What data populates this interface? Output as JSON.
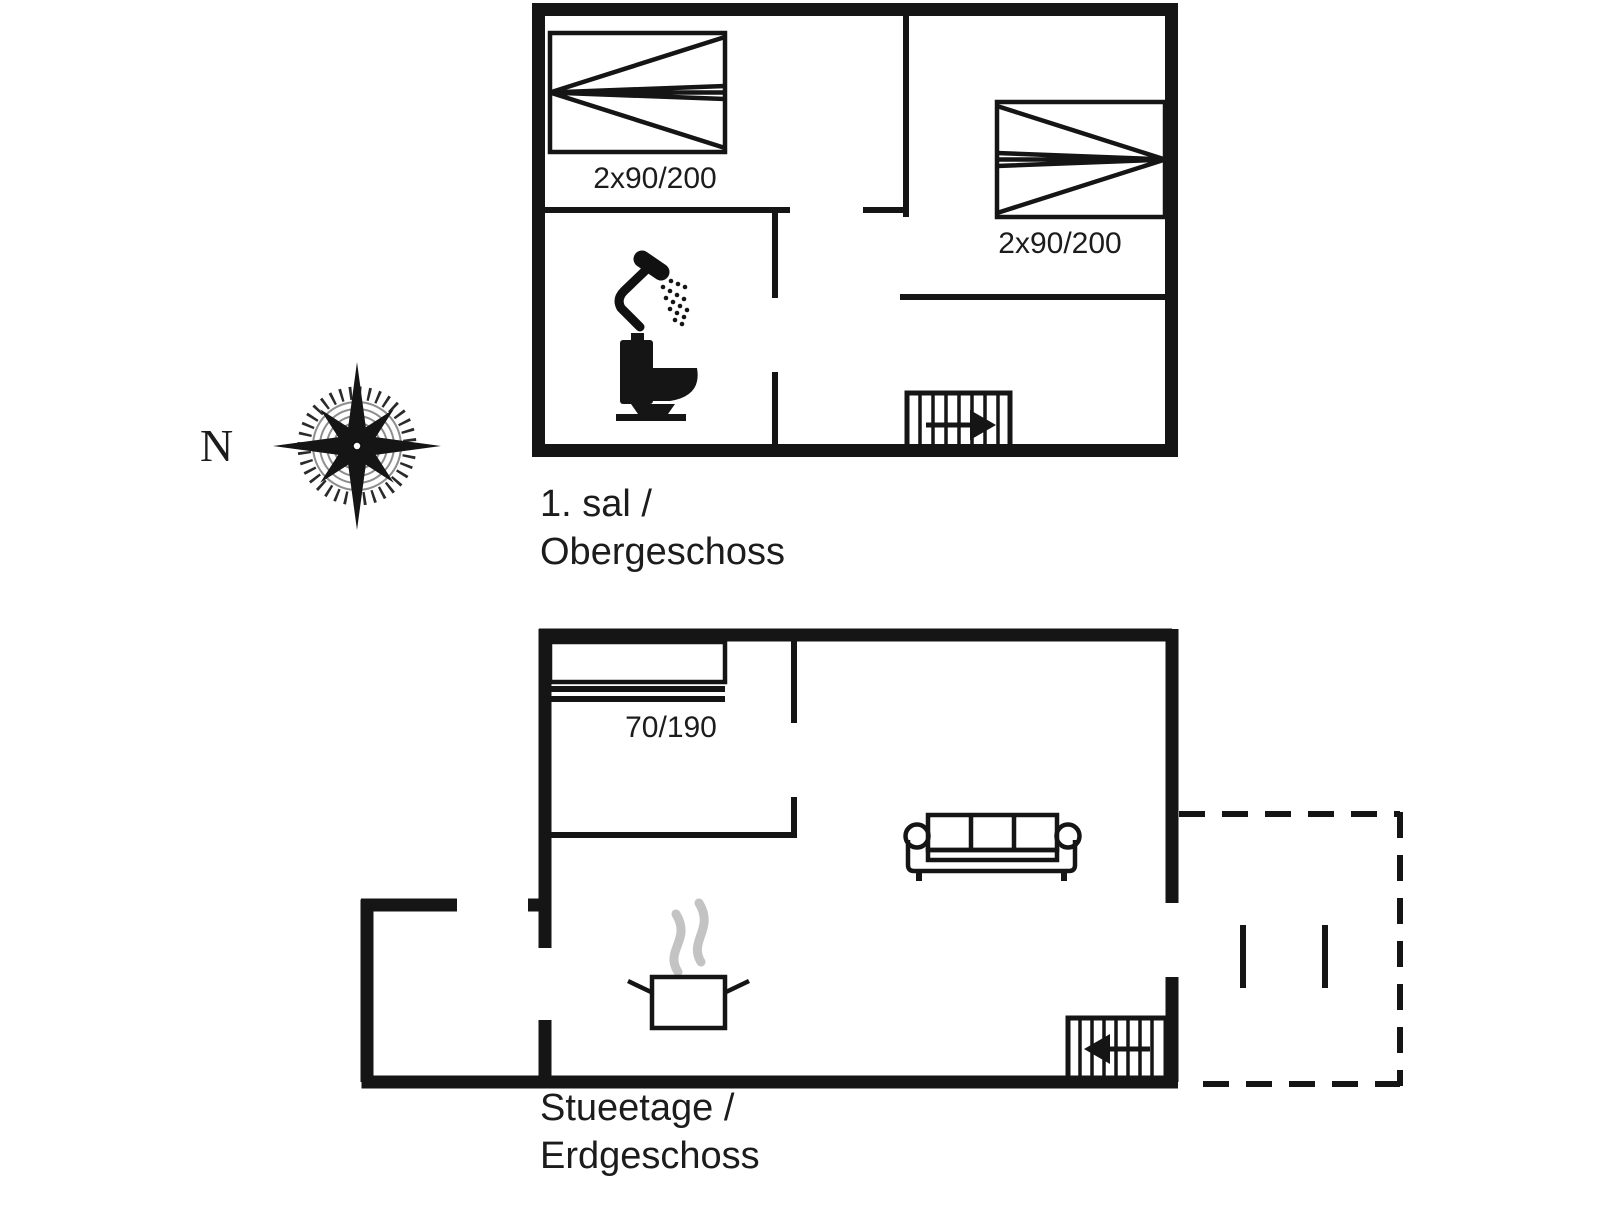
{
  "colors": {
    "wall": "#151515",
    "steam": "#c3c3c3",
    "background": "#ffffff"
  },
  "compass": {
    "north_label": "N"
  },
  "floors": {
    "upper": {
      "title_line1": "1. sal /",
      "title_line2": "Obergeschoss",
      "bed_left_label": "2x90/200",
      "bed_right_label": "2x90/200"
    },
    "ground": {
      "title_line1": "Stueetage /",
      "title_line2": "Erdgeschoss",
      "bed_label": "70/190"
    }
  }
}
